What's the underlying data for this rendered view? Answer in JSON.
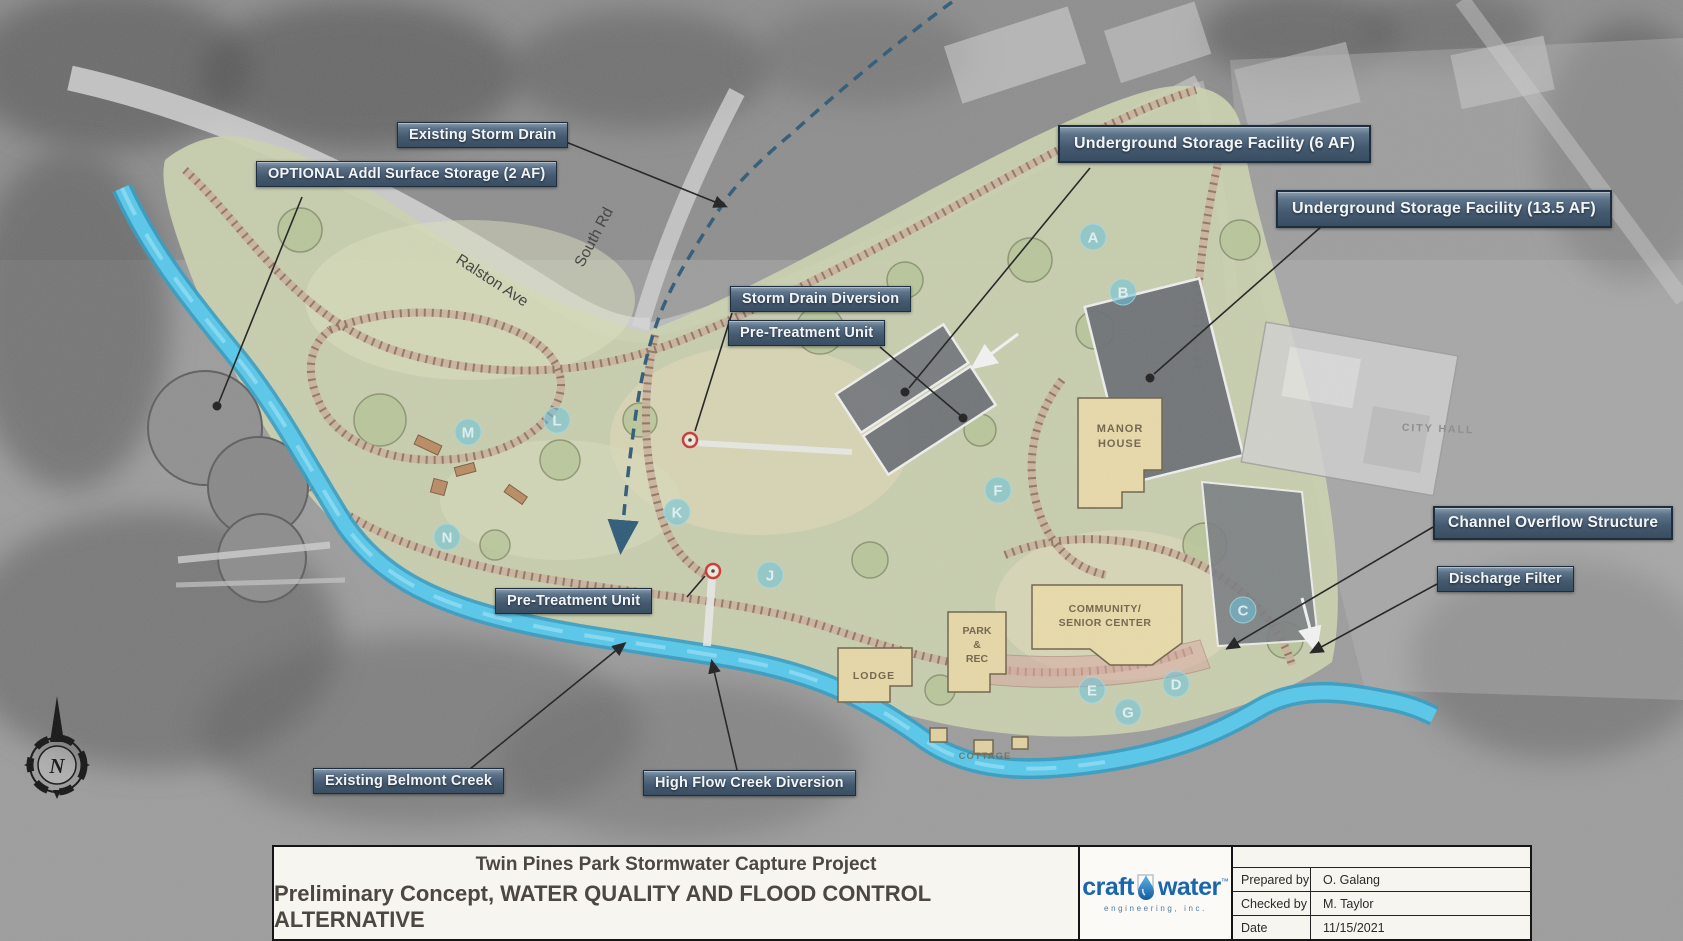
{
  "sheet": {
    "title_line1": "Twin Pines Park Stormwater Capture Project",
    "title_line2": "Preliminary Concept, WATER QUALITY AND FLOOD CONTROL ALTERNATIVE",
    "logo": {
      "brand_part1": "craft",
      "brand_part2": "water",
      "trademark": "™",
      "subtitle": "engineering, inc."
    },
    "info_table": {
      "rows": [
        {
          "label": "Prepared by",
          "value": "O. Galang"
        },
        {
          "label": "Checked by",
          "value": "M. Taylor"
        },
        {
          "label": "Date",
          "value": "11/15/2021"
        }
      ]
    }
  },
  "map": {
    "annotations": [
      {
        "text": "Existing Storm Drain"
      },
      {
        "text": "OPTIONAL Addl Surface Storage (2 AF)"
      },
      {
        "text": "Underground Storage Facility (6 AF)"
      },
      {
        "text": "Underground Storage Facility (13.5 AF)"
      },
      {
        "text": "Storm Drain Diversion"
      },
      {
        "text": "Pre-Treatment Unit"
      },
      {
        "text": "Pre-Treatment Unit"
      },
      {
        "text": "Channel Overflow Structure"
      },
      {
        "text": "Discharge Filter"
      },
      {
        "text": "Existing Belmont Creek"
      },
      {
        "text": "High Flow Creek Diversion"
      }
    ],
    "roads": [
      {
        "name": "Ralston Ave"
      },
      {
        "name": "South Rd"
      }
    ],
    "places": {
      "manor_line1": "MANOR",
      "manor_line2": "HOUSE",
      "community_line1": "COMMUNITY/",
      "community_line2": "SENIOR CENTER",
      "park_line1": "PARK",
      "park_line2": "&",
      "park_line3": "REC",
      "lodge": "LODGE",
      "cottage": "COTTAGE",
      "city_hall": "CITY HALL"
    },
    "compass_label": "N",
    "letter_markers": [
      {
        "letter": "A",
        "x": 1093,
        "y": 237
      },
      {
        "letter": "B",
        "x": 1123,
        "y": 292
      },
      {
        "letter": "C",
        "x": 1243,
        "y": 610
      },
      {
        "letter": "D",
        "x": 1176,
        "y": 684
      },
      {
        "letter": "E",
        "x": 1092,
        "y": 690
      },
      {
        "letter": "F",
        "x": 998,
        "y": 490
      },
      {
        "letter": "G",
        "x": 1128,
        "y": 712
      },
      {
        "letter": "J",
        "x": 770,
        "y": 575
      },
      {
        "letter": "K",
        "x": 677,
        "y": 512
      },
      {
        "letter": "L",
        "x": 557,
        "y": 420
      },
      {
        "letter": "M",
        "x": 468,
        "y": 432
      },
      {
        "letter": "N",
        "x": 447,
        "y": 537
      }
    ],
    "colors": {
      "creek": "#55c8ec",
      "creek_edge": "#2d9cc4",
      "park_green": "#ccd3b0",
      "label_box": "#44596f",
      "storm_drain_line": "#2b5876",
      "logo_blue": "#1a66ae"
    }
  }
}
